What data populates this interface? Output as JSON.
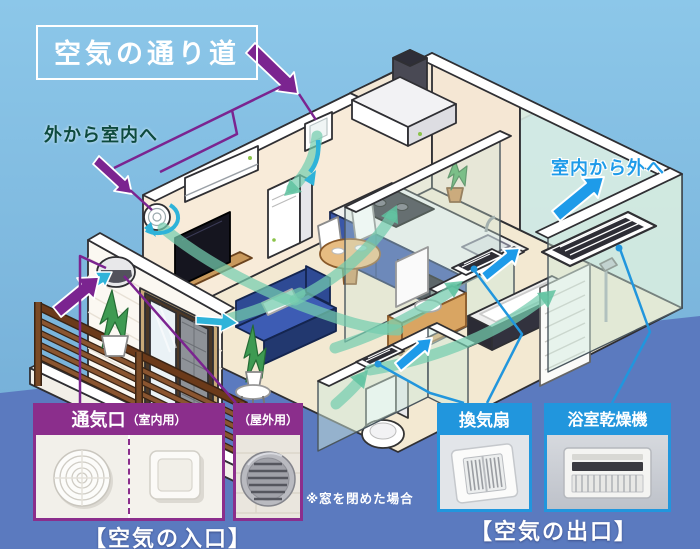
{
  "title": "空気の通り道",
  "labels": {
    "outside_to_inside": "外から室内へ",
    "inside_to_outside": "室内から外へ",
    "window_note": "※窓を閉めた場合"
  },
  "inlet": {
    "vent_title": "通気口",
    "vent_subtitle": "（室内用）",
    "outdoor_title": "（屋外用）",
    "caption": "【空気の入口】"
  },
  "outlet": {
    "fan_title": "換気扇",
    "dryer_title": "浴室乾燥機",
    "caption": "【空気の出口】"
  },
  "colors": {
    "sky": "#85c1e6",
    "ground_band": "#5b7abf",
    "inlet_accent_purple": "#8b2e8c",
    "outlet_accent_blue": "#2196dd",
    "inflow_label_green": "#0d4a3e",
    "outflow_label_blue": "#1e9be9",
    "airflow_teal": "#74cdaf",
    "intake_cyan": "#2fb3d9"
  }
}
